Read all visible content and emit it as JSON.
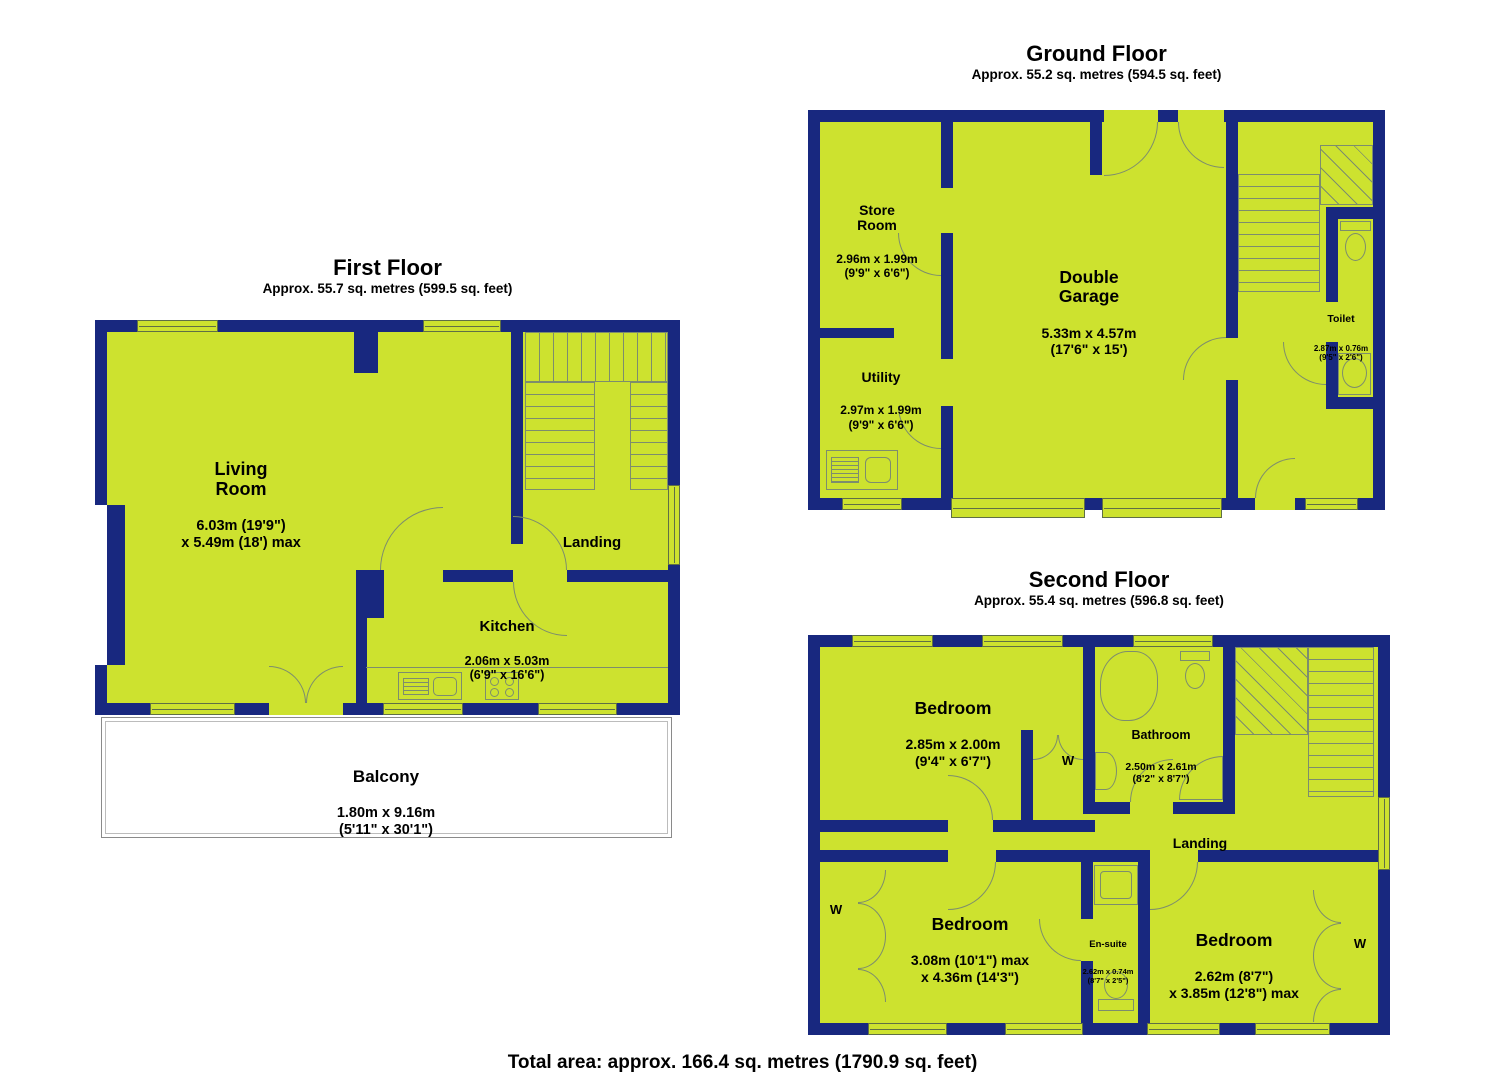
{
  "colors": {
    "wall": "#18287f",
    "floor": "#cde22f",
    "line": "#7d8d6d",
    "winline": "#5f6f46"
  },
  "first_floor": {
    "title": "First Floor",
    "subtitle": "Approx. 55.7 sq. metres (599.5 sq. feet)",
    "living_room": {
      "name": "Living\nRoom",
      "dims": "6.03m (19'9\")\nx 5.49m (18') max"
    },
    "landing": {
      "name": "Landing"
    },
    "kitchen": {
      "name": "Kitchen",
      "dims": "2.06m x 5.03m\n(6'9\" x 16'6\")"
    },
    "balcony": {
      "name": "Balcony",
      "dims": "1.80m x 9.16m\n(5'11\" x 30'1\")"
    }
  },
  "ground_floor": {
    "title": "Ground Floor",
    "subtitle": "Approx. 55.2 sq. metres (594.5 sq. feet)",
    "store_room": {
      "name": "Store\nRoom",
      "dims": "2.96m x 1.99m\n(9'9\" x 6'6\")"
    },
    "utility": {
      "name": "Utility",
      "dims": "2.97m x 1.99m\n(9'9\" x 6'6\")"
    },
    "double_garage": {
      "name": "Double\nGarage",
      "dims": "5.33m x 4.57m\n(17'6\" x 15')"
    },
    "toilet": {
      "name": "Toilet",
      "dims": "2.87m x 0.76m\n(9'5\" x 2'6\")"
    }
  },
  "second_floor": {
    "title": "Second Floor",
    "subtitle": "Approx. 55.4 sq. metres (596.8 sq. feet)",
    "bedroom_top": {
      "name": "Bedroom",
      "dims": "2.85m x 2.00m\n(9'4\" x 6'7\")"
    },
    "bathroom": {
      "name": "Bathroom",
      "dims": "2.50m x 2.61m\n(8'2\" x 8'7\")"
    },
    "landing": {
      "name": "Landing"
    },
    "bedroom_left": {
      "name": "Bedroom",
      "dims": "3.08m (10'1\") max\nx 4.36m (14'3\")"
    },
    "ensuite": {
      "name": "En-suite",
      "dims": "2.62m x 0.74m\n(8'7\" x 2'5\")"
    },
    "bedroom_right": {
      "name": "Bedroom",
      "dims": "2.62m (8'7\")\nx 3.85m (12'8\") max"
    },
    "wardrobe_label": "W"
  },
  "total_area": "Total area: approx. 166.4 sq. metres (1790.9 sq. feet)"
}
